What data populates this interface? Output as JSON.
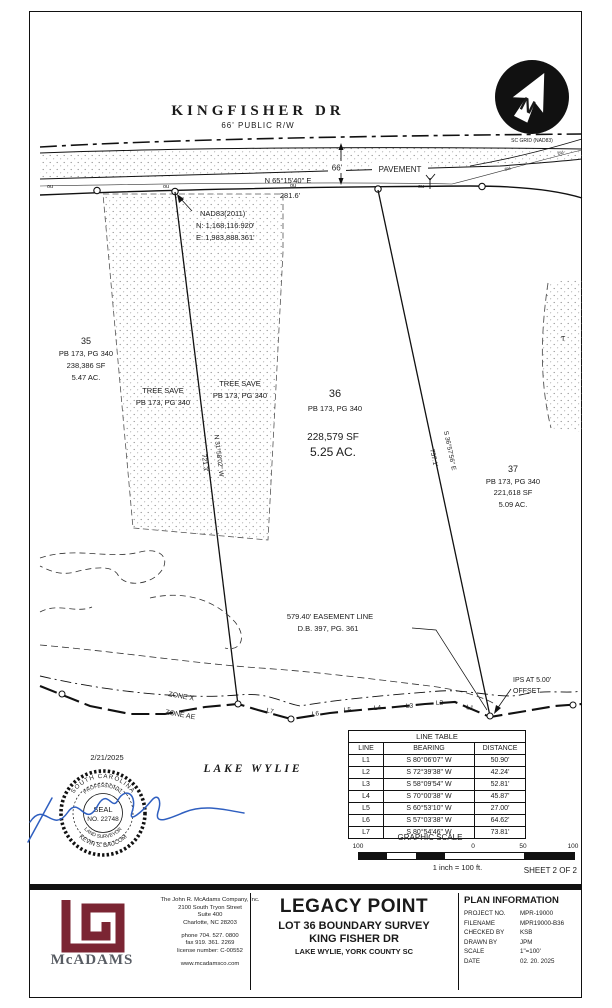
{
  "road": {
    "name": "KINGFISHER  DR",
    "rw": "66'  PUBLIC  R/W",
    "pavement": "PAVEMENT",
    "width_dim": "66'",
    "bearing": "N 65°15'40\" E",
    "distance": "281.6'",
    "utility_label": "ou"
  },
  "north_arrow": {
    "letter": "N",
    "caption": "SC GRID (NAD83)"
  },
  "nad": {
    "l1": "NAD83(2011)",
    "l2": "N: 1,168,116.920'",
    "l3": "E: 1,983,888.361'"
  },
  "lots": {
    "lot35": {
      "num": "35",
      "plat": "PB 173, PG 340",
      "sf": "238,386 SF",
      "ac": "5.47 AC."
    },
    "lot36": {
      "num": "36",
      "plat": "PB 173, PG 340",
      "sf": "228,579 SF",
      "ac": "5.25 AC."
    },
    "lot37": {
      "num": "37",
      "plat": "PB 173, PG 340",
      "sf": "221,618 SF",
      "ac": "5.09 AC."
    }
  },
  "tree_save": {
    "l1": "TREE SAVE",
    "l2": "PB 173, PG 340",
    "partial": "T"
  },
  "bearings": {
    "west": {
      "bearing": "N 31°58'02\" W",
      "dist": "721.3'"
    },
    "east": {
      "bearing": "S 36°57'56\" E",
      "dist": "757.1'"
    }
  },
  "easement": {
    "l1": "579.40' EASEMENT LINE",
    "l2": "D.B.  397, PG. 361"
  },
  "ips": {
    "l1": "IPS AT 5.00'",
    "l2": "OFFSET"
  },
  "zones": {
    "x": "ZONE X",
    "ae": "ZONE AE"
  },
  "lake": "LAKE  WYLIE",
  "seal": {
    "date": "2/21/2025",
    "arc_top": "SOUTH CAROLINA",
    "arc_top2": "PROFESSIONAL",
    "c1": "SEAL",
    "c2": "NO. 22748",
    "arc_bot2": "LAND SURVEYOR",
    "arc_bot": "KEVIN S. BAUCOM"
  },
  "shore_labels": [
    "L7",
    "L6",
    "L5",
    "L4",
    "L3",
    "L2",
    "L1"
  ],
  "line_table": {
    "title": "LINE TABLE",
    "headers": [
      "LINE",
      "BEARING",
      "DISTANCE"
    ],
    "rows": [
      [
        "L1",
        "S 80°06'07\" W",
        "50.90'"
      ],
      [
        "L2",
        "S 72°39'38\" W",
        "42.24'"
      ],
      [
        "L3",
        "S 58°09'54\" W",
        "52.81'"
      ],
      [
        "L4",
        "S 70°00'38\" W",
        "45.87'"
      ],
      [
        "L5",
        "S 60°53'10\" W",
        "27.00'"
      ],
      [
        "L6",
        "S 57°03'38\" W",
        "64.62'"
      ],
      [
        "L7",
        "S 80°54'46\" W",
        "73.81'"
      ]
    ]
  },
  "graphic_scale": {
    "title": "GRAPHIC SCALE",
    "ticks": [
      "100",
      "0",
      "50",
      "100"
    ],
    "caption": "1 inch = 100 ft.",
    "sheet": "SHEET 2 OF 2"
  },
  "title_block": {
    "company": {
      "wordmark": "McADAMS",
      "name": "The John R. McAdams Company, Inc.",
      "addr1": "2100 South Tryon Street",
      "addr2": "Suite 400",
      "addr3": "Charlotte, NC 28203",
      "phone": "phone 704. 527. 0800",
      "fax": "fax 919. 361. 2269",
      "license": "license number: C-00552",
      "web": "www.mcadamsco.com"
    },
    "project": {
      "title": "LEGACY POINT",
      "sub1": "LOT 36 BOUNDARY SURVEY",
      "sub2": "KING FISHER DR",
      "sub3": "LAKE WYLIE, YORK COUNTY SC"
    },
    "plan_info": {
      "title": "PLAN INFORMATION",
      "rows": [
        [
          "PROJECT NO.",
          "MPR-19000"
        ],
        [
          "FILENAME",
          "MPR19000-B36"
        ],
        [
          "CHECKED BY",
          "KSB"
        ],
        [
          "DRAWN BY",
          "JPM"
        ],
        [
          "SCALE",
          "1\"=100'"
        ],
        [
          "DATE",
          "02. 20. 2025"
        ]
      ]
    }
  },
  "colors": {
    "maroon": "#7b2533",
    "signature_blue": "#2f5fc0",
    "ink": "#111111"
  }
}
